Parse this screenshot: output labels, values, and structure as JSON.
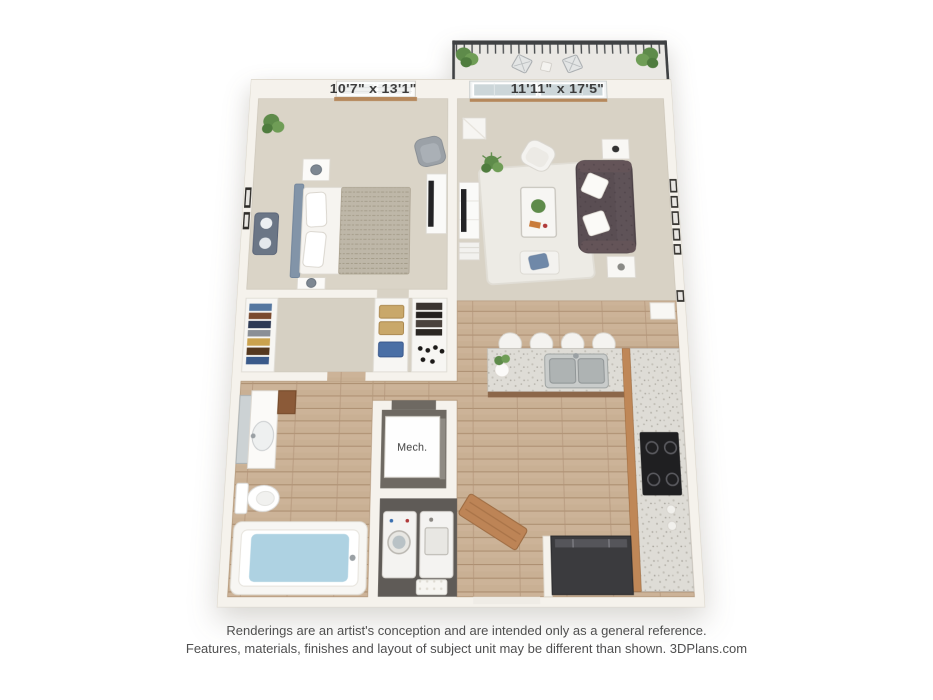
{
  "floor_plan": {
    "labels": {
      "bedroom_dimensions": "10'7\" x 13'1\"",
      "living_room_dimensions": "11'11\" x 17'5\"",
      "mech_room": "Mech."
    },
    "rooms": [
      "bedroom",
      "living-room",
      "balcony",
      "walk-in-closet",
      "bathroom",
      "mechanical-closet",
      "laundry-closet",
      "kitchen",
      "entry"
    ],
    "colors": {
      "wall": "#f5f2ec",
      "bedroom_carpet": "#dad4c7",
      "living_carpet": "#d8d2c5",
      "closet_carpet": "#d6d0c3",
      "wood_floor": "#c9b094",
      "cabinet_wood": "#bf8757",
      "granite_counter": "#dedcd6",
      "sofa": "#5a4e53",
      "headboard": "#8294a8",
      "bath_water": "#aed2e2",
      "plant_green": "#5e8b4a",
      "railing": "#3f4143",
      "appliance_dark": "#3b3b3e",
      "label_text": "#3a3a3a",
      "disclaimer_text": "#4f4f4f"
    }
  },
  "disclaimer": {
    "line1": "Renderings are an artist's conception and are intended only as a general reference.",
    "line2": "Features, materials, finishes and layout of subject unit may be different than shown. 3DPlans.com"
  }
}
